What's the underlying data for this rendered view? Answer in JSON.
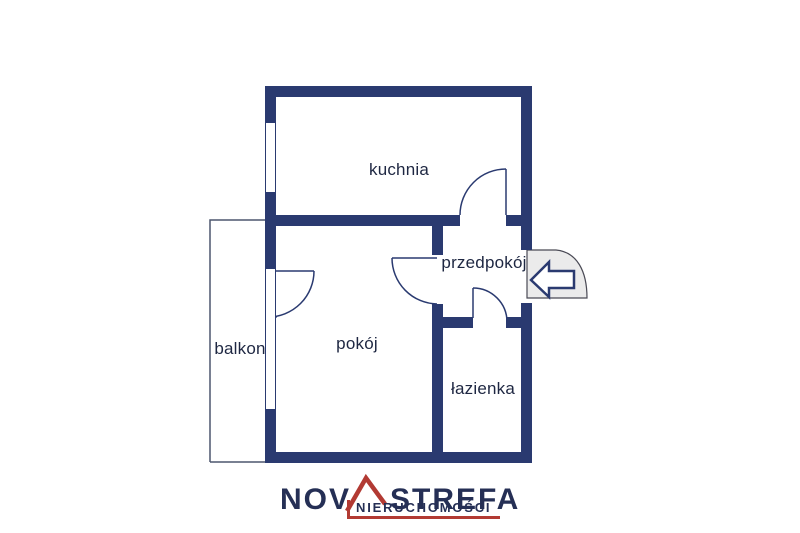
{
  "floor_plan": {
    "rooms": [
      {
        "id": "kuchnia",
        "label": "kuchnia"
      },
      {
        "id": "pokoj",
        "label": "pokój"
      },
      {
        "id": "przedpokoj",
        "label": "przedpokój"
      },
      {
        "id": "lazienka",
        "label": "łazienka"
      },
      {
        "id": "balkon",
        "label": "balkon"
      }
    ],
    "entrance": {
      "icon": "entrance-arrow-icon",
      "meaning": "entrance arrow pointing into the apartment"
    }
  },
  "logo": {
    "brand_prefix": "NOV",
    "brand_suffix": "STREFA",
    "subtitle": "NIERUCHOMOŚCI"
  },
  "colors": {
    "background": "#ffffff",
    "wall": "#2a3a70",
    "line": "#2a3a70",
    "balcony_line": "#4d566e",
    "label_text": "#1e2742",
    "entrance_fill": "#ebebeb",
    "entrance_outline": "#4a4a55",
    "logo_navy": "#252f55",
    "logo_red": "#b23a33"
  }
}
